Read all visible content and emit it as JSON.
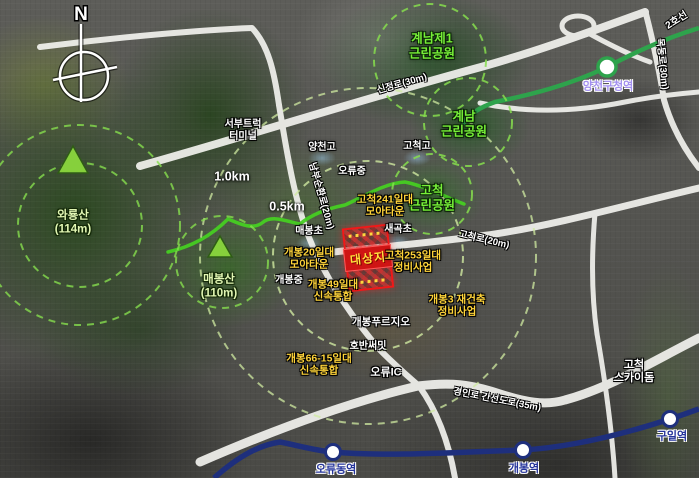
{
  "compass": {
    "label": "N"
  },
  "site": {
    "label": "대상지"
  },
  "rings": {
    "r500": "0.5km",
    "r1000": "1.0km"
  },
  "mountains": {
    "waryong": "와룡산\n(114m)",
    "maebong": "매봉산\n(110m)"
  },
  "parks": {
    "gyenam1": "계남제1\n근린공원",
    "gyenam": "계남\n근린공원",
    "gocheok": "고척\n근린공원"
  },
  "schools": {
    "yangcheongo": "양천고",
    "gocheokgo": "고척고",
    "oryujung": "오류중",
    "maebongcho": "매봉초",
    "saegokcho": "새곡초",
    "gaebongjung": "개봉중"
  },
  "projects": {
    "gocheok241": "고척241일대\n모아타운",
    "gaebong20": "개봉20일대\n모아타운",
    "gaebong49": "개봉49일대\n신속통합",
    "gaebong66": "개봉66-15일대\n신속통합",
    "gocheok253": "고척253일대\n정비사업",
    "gaebong3": "개봉3 재건축\n정비사업"
  },
  "places": {
    "truck_terminal": "서부트럭\n터미널",
    "purugio": "개봉푸르지오",
    "hoban": "호반써밋",
    "oryu_ic": "오류IC",
    "skydome": "고척\n스카이돔"
  },
  "roads": {
    "sinjeong": "신정로(30m)",
    "nambu": "남부순환로(20m)",
    "gocheokro": "고척로(20m)",
    "gyeongin": "경인로 간선도로(35m)",
    "mokdong": "목동로(30m)"
  },
  "transit": {
    "line2_label": "2호선",
    "yangcheon_gu_office": "양천구청역",
    "oryudong": "오류동역",
    "gaebong_station": "개봉역",
    "guil": "구일역"
  },
  "colors": {
    "line1_navy": "#1e2f7d",
    "line2_green": "#2ea34c",
    "site_red": "#f21818",
    "project_yellow": "#ffd43a",
    "park_green": "#77ef38",
    "trail_green": "#46cf22"
  }
}
